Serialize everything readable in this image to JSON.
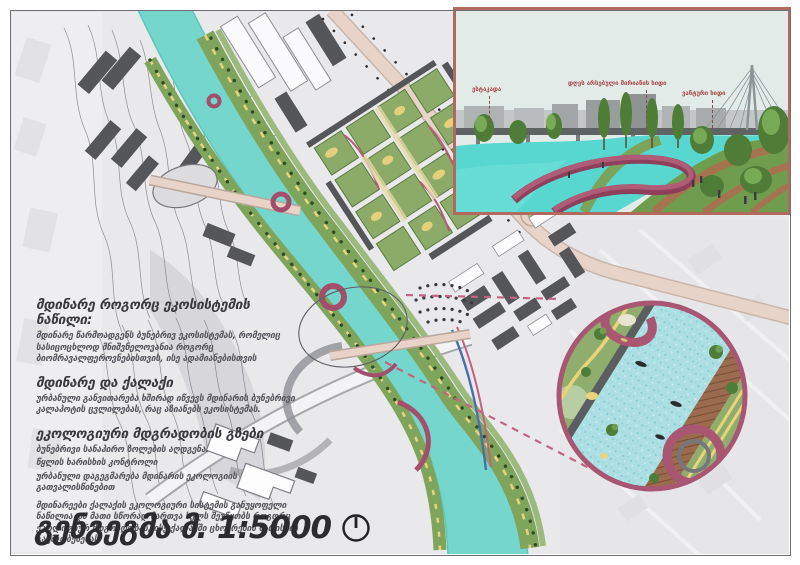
{
  "text_panel": {
    "sections": [
      {
        "heading": "მდინარე როგორც ეკოსისტემის ნაწილი:",
        "body": "მდინარე წარმოადგენს ბუნებრივ ეკოსისტემას, რომელიც სასიცოცხლოდ მნიშვნელოვანია როგორც ბიომრავალფეროვნებისთვის, ისე ადამიანებისთვის"
      },
      {
        "heading": "მდინარე და ქალაქი",
        "body": "ურბანული განვითარება ხშირად იწვევს მდინარის ბუნებრივი კალაპოტის ცვლილებას, რაც აზიანებს ეკოსისტემას."
      },
      {
        "heading": "ეკოლოგიური მდგრადობის გზები",
        "bullets": [
          "ბუნებრივი სანაპირო ზოლების აღდგენა.",
          "წყლის ხარისხის კონტროლი",
          "ურბანული დაგეგმარება მდინარის ეკოლოგიის გათვალისწინებით"
        ],
        "body": "მდინარეები ქალაქის ეკოლოგიური სისტემის განუყოფელი ნაწილია და მათი სწორად მართვა ხელს შეუწყობს როგორც ეკოლოგიურ მდგრადობას, ისე ქალაქში ცხოვრების ხარისხის გაუმჯობესებას"
      }
    ],
    "scale_title": "გენგეგმა მ. 1:5000"
  },
  "inset": {
    "labels": [
      "ესტაკადა",
      "დღეს არსებული მირიანის ხიდი",
      "ვანტური ხიდი"
    ]
  },
  "icons": {
    "north_indicator": "circle with north tick",
    "detail_circle": "zoom detail bubble"
  },
  "colors": {
    "river": "#74d6cc",
    "park_green": "#7fa55c",
    "maroon_accent": "#a34e6b",
    "road_tan": "#e3cfc3",
    "inset_frame": "#b26a5f",
    "label_red": "#a84848",
    "building_dark": "#55565a"
  }
}
